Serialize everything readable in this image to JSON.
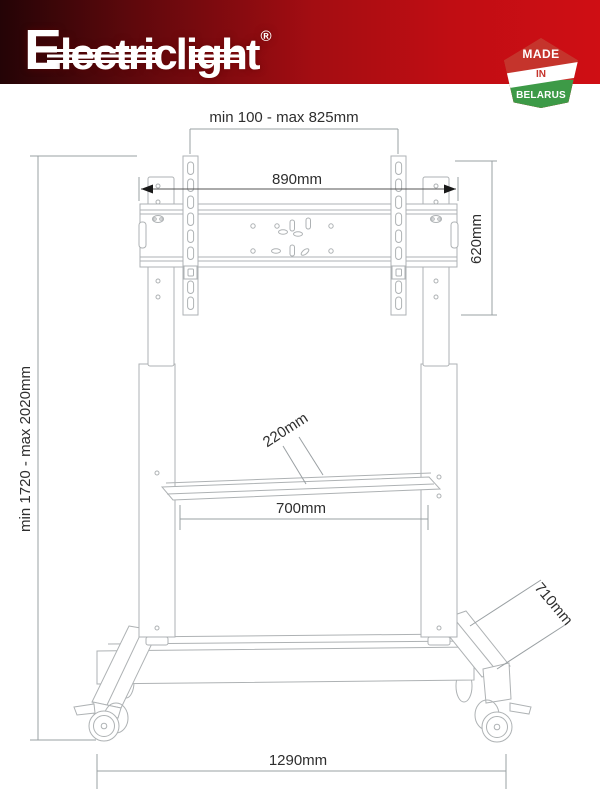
{
  "brand": {
    "name": "Electriclight",
    "registered": "®"
  },
  "badge": {
    "line1": "MADE",
    "line2": "IN",
    "line3": "BELARUS"
  },
  "colors": {
    "banner_dark": "#240406",
    "banner_red": "#cf0e14",
    "badge_red": "#c5342c",
    "badge_green": "#3d9a47",
    "drawing_line": "#aeb2b4",
    "dimension_line": "#9aa0a3",
    "dimension_text": "#2e2e2e"
  },
  "drawing": {
    "dimensions": {
      "vesa_span": "min 100 - max 825mm",
      "mount_width": "890mm",
      "mount_height": "620mm",
      "overall_height": "min 1720 - max 2020mm",
      "shelf_depth": "220mm",
      "shelf_width": "700mm",
      "base_depth": "710mm",
      "base_width": "1290mm"
    }
  }
}
